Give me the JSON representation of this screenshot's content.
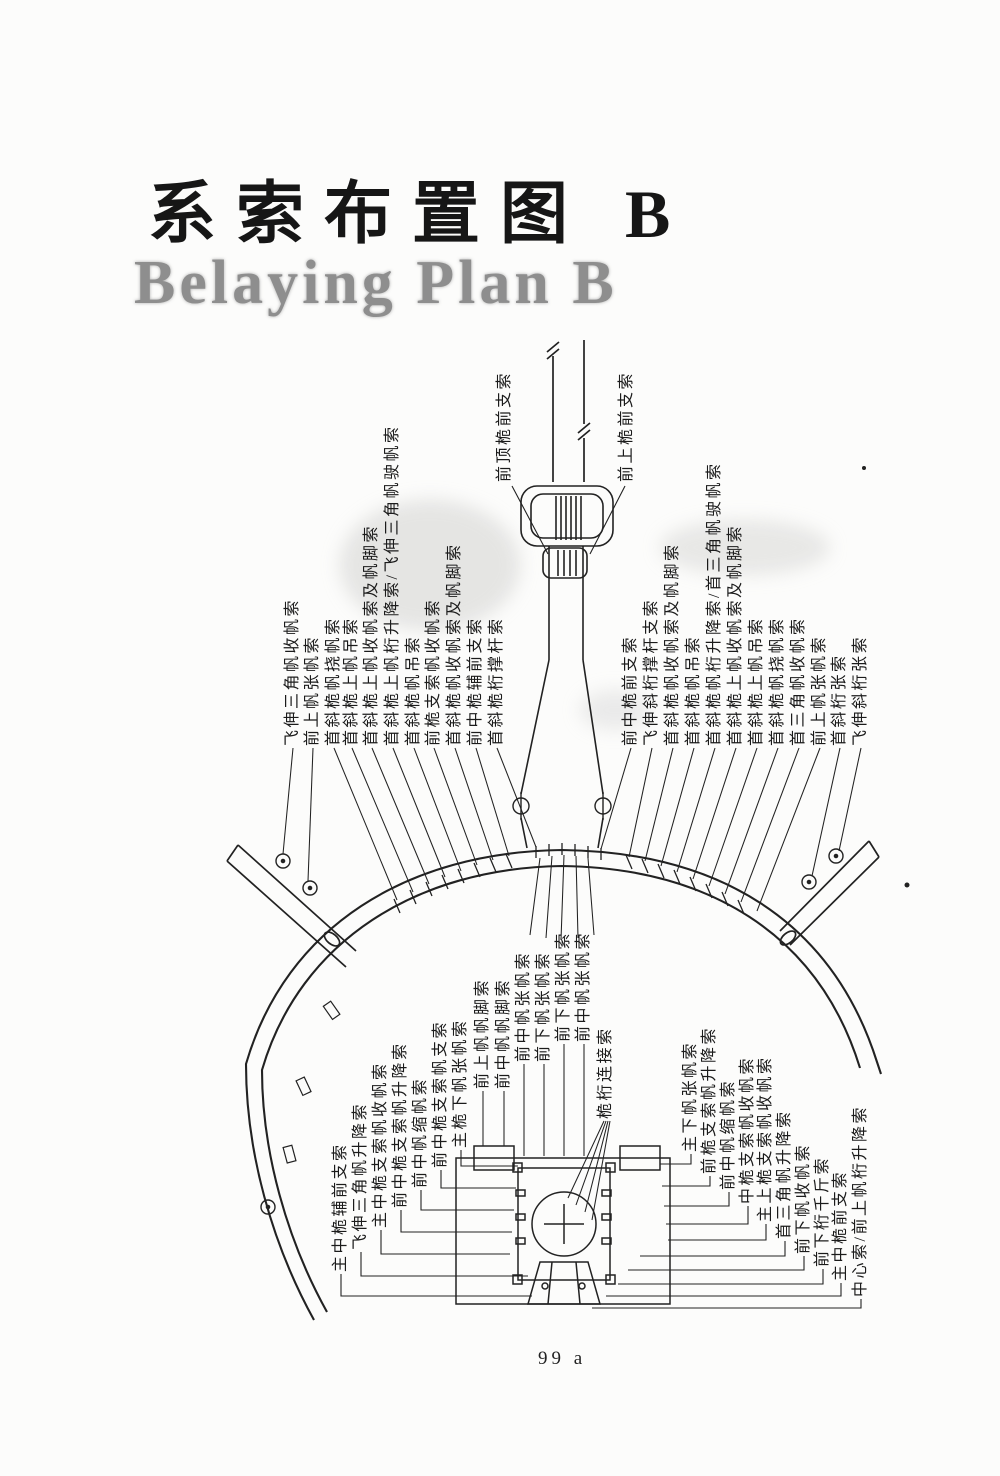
{
  "title": {
    "cn": "系索布置图 B",
    "en": "Belaying Plan B"
  },
  "page_number": "99 a",
  "bowsprit_labels": [
    {
      "text": "前顶桅前支索",
      "x": 505,
      "y": 482
    },
    {
      "text": "前上桅前支索",
      "x": 627,
      "y": 482
    }
  ],
  "left_group": [
    {
      "text": "飞伸三角帆收帆索",
      "x": 293,
      "y": 746
    },
    {
      "text": "前上帆张帆索",
      "x": 313,
      "y": 746
    },
    {
      "text": "首斜桅帆挠帆索",
      "x": 334,
      "y": 746
    },
    {
      "text": "首斜桅上帆吊索",
      "x": 352,
      "y": 746
    },
    {
      "text": "首斜桅上帆收帆索及帆脚索",
      "x": 372,
      "y": 746
    },
    {
      "text": "首斜桅上帆桁升降索/飞伸三角帆驶帆索",
      "x": 393,
      "y": 746
    },
    {
      "text": "首斜桅帆吊索",
      "x": 414,
      "y": 746
    },
    {
      "text": "前桅支索帆收帆索",
      "x": 434,
      "y": 746
    },
    {
      "text": "首斜桅帆收帆索及帆脚索",
      "x": 455,
      "y": 746
    },
    {
      "text": "前中桅辅前支索",
      "x": 476,
      "y": 746
    },
    {
      "text": "首斜桅桁撑杆索",
      "x": 497,
      "y": 746
    }
  ],
  "right_group": [
    {
      "text": "前中桅前支索",
      "x": 631,
      "y": 746
    },
    {
      "text": "飞伸斜桁撑杆支索",
      "x": 652,
      "y": 746
    },
    {
      "text": "首斜桅帆收帆索及帆脚索",
      "x": 673,
      "y": 746
    },
    {
      "text": "首斜桅帆吊索",
      "x": 694,
      "y": 746
    },
    {
      "text": "首斜桅帆桁升降索/首三角帆驶帆索",
      "x": 715,
      "y": 746
    },
    {
      "text": "首斜桅上帆收帆索及帆脚索",
      "x": 736,
      "y": 746
    },
    {
      "text": "首斜桅上帆吊索",
      "x": 757,
      "y": 746
    },
    {
      "text": "首斜桅帆挠帆索",
      "x": 778,
      "y": 746
    },
    {
      "text": "首三角帆收帆索",
      "x": 799,
      "y": 746
    },
    {
      "text": "前上帆张帆索",
      "x": 820,
      "y": 746
    },
    {
      "text": "首斜桁张索",
      "x": 840,
      "y": 746
    },
    {
      "text": "飞伸斜桁张索",
      "x": 861,
      "y": 746
    }
  ],
  "mid_group": [
    {
      "text": "前上帆帆脚索",
      "x": 483,
      "y": 1089
    },
    {
      "text": "前中帆帆脚索",
      "x": 504,
      "y": 1089
    },
    {
      "text": "前中帆张帆索",
      "x": 524,
      "y": 1062
    },
    {
      "text": "前下帆张帆索",
      "x": 544,
      "y": 1062
    },
    {
      "text": "前下帆张帆索",
      "x": 564,
      "y": 1042
    },
    {
      "text": "前中帆张帆索",
      "x": 584,
      "y": 1042
    },
    {
      "text": "桅桁连接索",
      "x": 606,
      "y": 1119
    }
  ],
  "lower_left_group": [
    {
      "text": "主中桅辅前支索",
      "x": 341,
      "y": 1272
    },
    {
      "text": "飞伸三角帆升降索",
      "x": 361,
      "y": 1250
    },
    {
      "text": "主中桅支索帆收帆索",
      "x": 381,
      "y": 1228
    },
    {
      "text": "前中桅支索帆升降索",
      "x": 401,
      "y": 1208
    },
    {
      "text": "前中帆缩帆索",
      "x": 421,
      "y": 1188
    },
    {
      "text": "前中桅支索帆支索",
      "x": 441,
      "y": 1168
    },
    {
      "text": "主桅下帆张帆索",
      "x": 461,
      "y": 1148
    }
  ],
  "lower_right_group": [
    {
      "text": "主下帆张帆索",
      "x": 691,
      "y": 1152
    },
    {
      "text": "前桅支索帆升降索",
      "x": 710,
      "y": 1174
    },
    {
      "text": "前中帆缩帆索",
      "x": 729,
      "y": 1190
    },
    {
      "text": "中桅支索帆收帆索",
      "x": 748,
      "y": 1204
    },
    {
      "text": "主上桅支索帆收帆索",
      "x": 766,
      "y": 1222
    },
    {
      "text": "首三角帆升降索",
      "x": 785,
      "y": 1239
    },
    {
      "text": "前下帆收帆索",
      "x": 804,
      "y": 1254
    },
    {
      "text": "前下桁千斤索",
      "x": 823,
      "y": 1267
    },
    {
      "text": "主中桅前支索",
      "x": 841,
      "y": 1281
    },
    {
      "text": "中心索/前上帆桁升降索",
      "x": 861,
      "y": 1297
    }
  ]
}
